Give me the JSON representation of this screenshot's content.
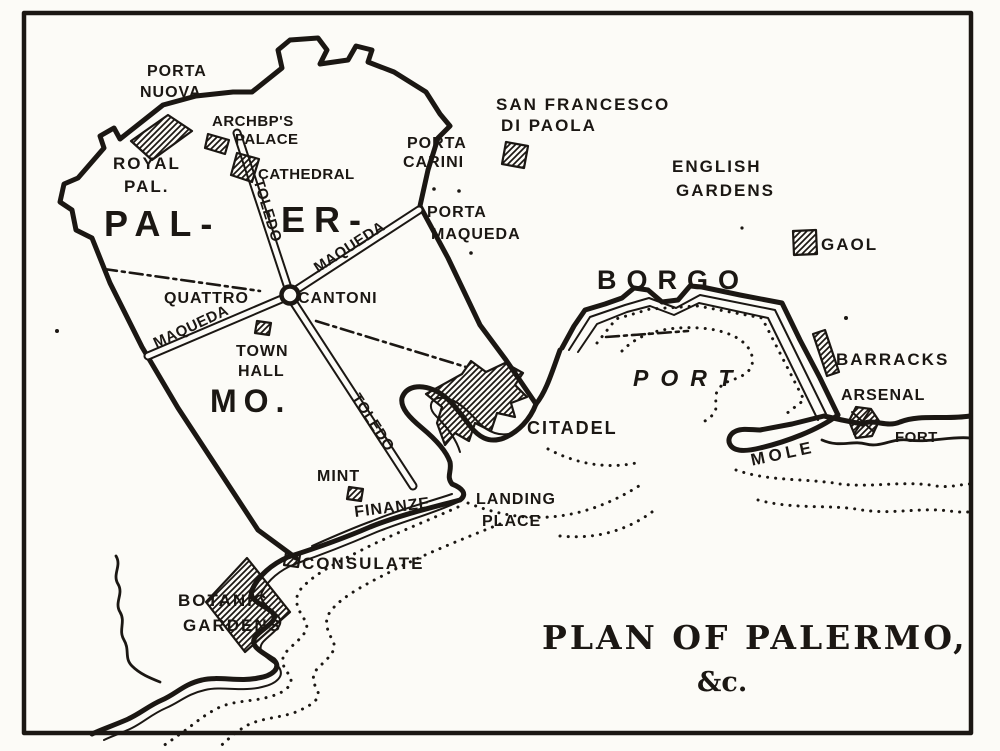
{
  "colors": {
    "ink": "#1b1713",
    "paper": "#fcfbf7"
  },
  "title": {
    "main": "PLAN OF PALERMO,",
    "etc": "&c."
  },
  "labels": {
    "porta_nuova_1": "PORTA",
    "porta_nuova_2": "NUOVA",
    "archbp_1": "ARCHBP'S",
    "archbp_2": "PALACE",
    "royal_1": "ROYAL",
    "royal_2": "PAL.",
    "cathedral": "CATHEDRAL",
    "porta_carini_1": "PORTA",
    "porta_carini_2": "CARINI",
    "san_francesco_1": "SAN FRANCESCO",
    "san_francesco_2": "DI PAOLA",
    "english_1": "ENGLISH",
    "english_2": "GARDENS",
    "porta_maqueda_1": "PORTA",
    "porta_maqueda_2": "MAQUEDA",
    "gaol": "GAOL",
    "pal": "PAL-",
    "er": "ER-",
    "mo": "MO.",
    "borgo": "BORGO",
    "quattro": "QUATTRO",
    "cantoni": "CANTONI",
    "toledo_upper": "TOLEDO",
    "toledo_lower": "TOLEDO",
    "maqueda_upper": "MAQUEDA",
    "maqueda_lower": "MAQUEDA",
    "town_hall_1": "TOWN",
    "town_hall_2": "HALL",
    "port": "PORT",
    "barracks": "BARRACKS",
    "arsenal": "ARSENAL",
    "citadel": "CITADEL",
    "mole": "MOLE",
    "fort": "FORT",
    "mint": "MINT",
    "finanze": "FINANZE",
    "landing_1": "LANDING",
    "landing_2": "PLACE",
    "consulate": "CONSULATE",
    "botanic_1": "BOTANIC",
    "botanic_2": "GARDENS"
  }
}
